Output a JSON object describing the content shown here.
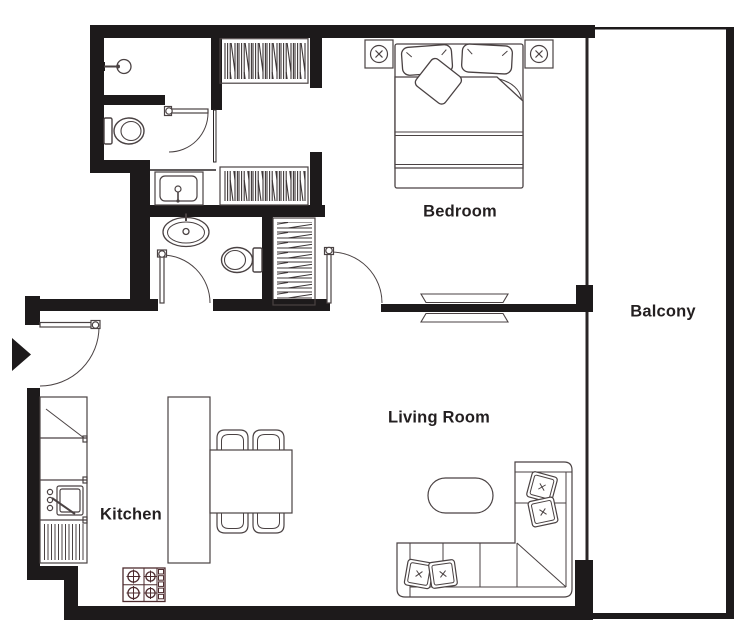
{
  "plan": {
    "type": "apartment-floor-plan",
    "rooms": [
      {
        "id": "bedroom",
        "label": "Bedroom"
      },
      {
        "id": "balcony",
        "label": "Balcony"
      },
      {
        "id": "living-room",
        "label": "Living Room"
      },
      {
        "id": "kitchen",
        "label": "Kitchen"
      }
    ],
    "fixtures": [
      "shower-head",
      "wc-toilet",
      "vanity-sink",
      "pedestal-sink",
      "bathroom-toilet",
      "wardrobe-closet-upper",
      "wardrobe-closet-lower",
      "linen-closet",
      "double-bed",
      "pillows",
      "throw-pillow",
      "wall-light-left",
      "wall-light-right",
      "sliding-door",
      "bedroom-door",
      "bathroom-door",
      "wc-door",
      "entry-door",
      "entry-arrow",
      "dining-table",
      "dining-chairs",
      "kitchen-counter",
      "kitchen-sink",
      "dish-rack",
      "kitchen-island",
      "stove-hob",
      "sectional-sofa",
      "sofa-pillows",
      "coffee-table"
    ]
  },
  "colors": {
    "wall": "#1d1a1b",
    "furniture_line": "#4a4243",
    "text": "#231f20",
    "background": "#ffffff"
  }
}
